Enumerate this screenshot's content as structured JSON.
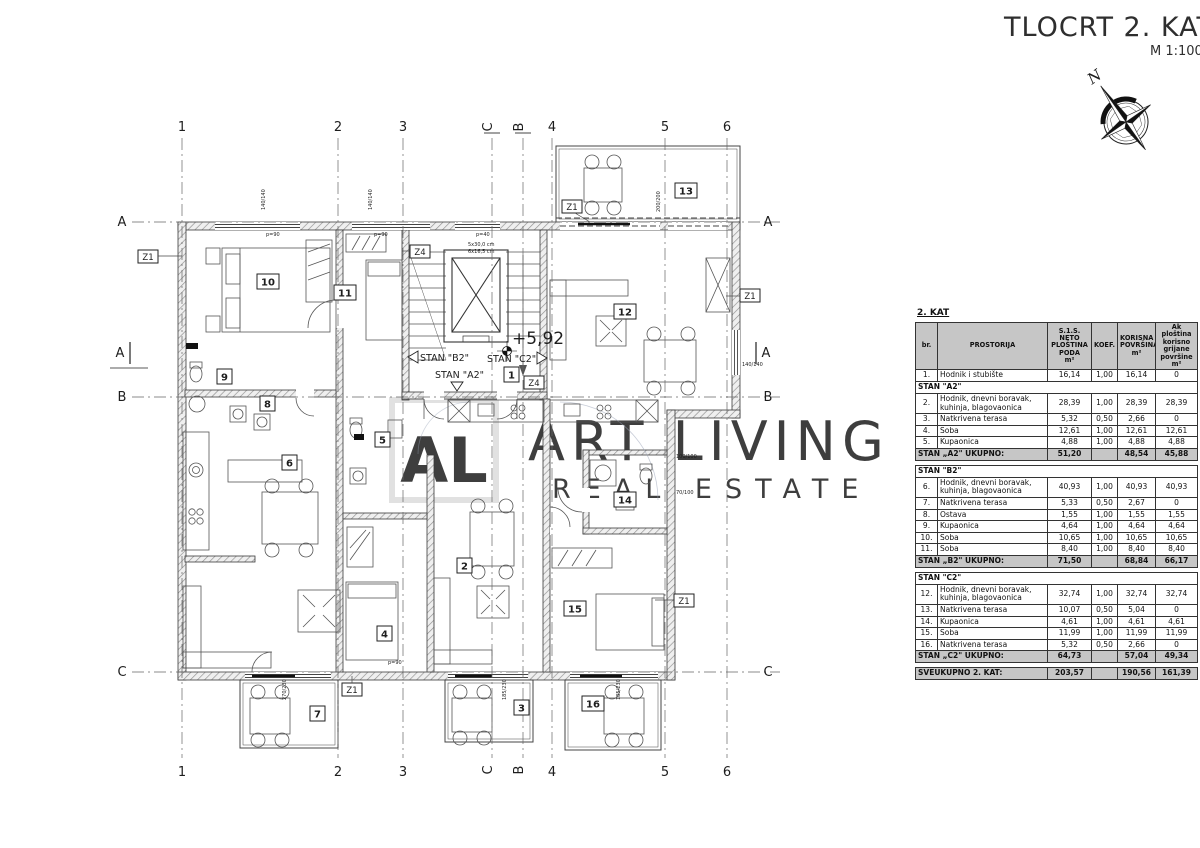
{
  "title": {
    "main": "TLOCRT 2. KATA",
    "scale": "M 1:100"
  },
  "compass": {
    "north": "N"
  },
  "watermark": {
    "logo": "AL",
    "line1": "ART LIVING",
    "line2": "REAL ESTATE"
  },
  "plan": {
    "grid_cols": [
      "1",
      "2",
      "3",
      "C",
      "B",
      "4",
      "5",
      "6"
    ],
    "grid_rows": [
      "A",
      "B",
      "C"
    ],
    "section_marker": "A",
    "rooms": [
      "1",
      "2",
      "3",
      "4",
      "5",
      "6",
      "7",
      "8",
      "9",
      "10",
      "11",
      "12",
      "13",
      "14",
      "15",
      "16"
    ],
    "zones": {
      "z1": "Z1",
      "z4": "Z4"
    },
    "apartments": {
      "a2": "STAN \"A2\"",
      "b2": "STAN \"B2\"",
      "c2": "STAN \"C2\""
    },
    "elevation": "+5,92",
    "stairs": {
      "note1": "5x30,0 cm",
      "note2": "6x16,5 cm"
    },
    "dims": {
      "p90": "p=90",
      "p40": "p=40",
      "d140": "140/140",
      "d270": "270/230",
      "d185": "185/230",
      "d100": "100/100",
      "d70": "70/100",
      "d200": "200/200"
    }
  },
  "table": {
    "caption": "2. KAT",
    "columns": [
      "br.",
      "PROSTORIJA",
      "S.1.S.\nNETO\nPLOŠTINA\nPODA\nm²",
      "KOEF.",
      "KORISNA\nPOVRŠINA\nm²",
      "Ak ploština\nkorisno\ngrijane\npovršine\nm²"
    ],
    "rows": [
      {
        "type": "data",
        "br": "1.",
        "name": "Hodnik i stubište",
        "neto": "16,14",
        "koef": "1,00",
        "korisna": "16,14",
        "ak": "0"
      },
      {
        "type": "section",
        "label": "STAN \"A2\""
      },
      {
        "type": "data",
        "br": "2.",
        "name": "Hodnik, dnevni boravak,\nkuhinja, blagovaonica",
        "neto": "28,39",
        "koef": "1,00",
        "korisna": "28,39",
        "ak": "28,39"
      },
      {
        "type": "data",
        "br": "3.",
        "name": "Natkrivena terasa",
        "neto": "5,32",
        "koef": "0,50",
        "korisna": "2,66",
        "ak": "0"
      },
      {
        "type": "data",
        "br": "4.",
        "name": "Soba",
        "neto": "12,61",
        "koef": "1,00",
        "korisna": "12,61",
        "ak": "12,61"
      },
      {
        "type": "data",
        "br": "5.",
        "name": "Kupaonica",
        "neto": "4,88",
        "koef": "1,00",
        "korisna": "4,88",
        "ak": "4,88"
      },
      {
        "type": "total",
        "label": "STAN „A2\" UKUPNO:",
        "neto": "51,20",
        "korisna": "48,54",
        "ak": "45,88"
      },
      {
        "type": "spacer"
      },
      {
        "type": "section",
        "label": "STAN \"B2\""
      },
      {
        "type": "data",
        "br": "6.",
        "name": "Hodnik, dnevni boravak,\nkuhinja, blagovaonica",
        "neto": "40,93",
        "koef": "1,00",
        "korisna": "40,93",
        "ak": "40,93"
      },
      {
        "type": "data",
        "br": "7.",
        "name": "Natkrivena terasa",
        "neto": "5,33",
        "koef": "0,50",
        "korisna": "2,67",
        "ak": "0"
      },
      {
        "type": "data",
        "br": "8.",
        "name": "Ostava",
        "neto": "1,55",
        "koef": "1,00",
        "korisna": "1,55",
        "ak": "1,55"
      },
      {
        "type": "data",
        "br": "9.",
        "name": "Kupaonica",
        "neto": "4,64",
        "koef": "1,00",
        "korisna": "4,64",
        "ak": "4,64"
      },
      {
        "type": "data",
        "br": "10.",
        "name": "Soba",
        "neto": "10,65",
        "koef": "1,00",
        "korisna": "10,65",
        "ak": "10,65"
      },
      {
        "type": "data",
        "br": "11.",
        "name": "Soba",
        "neto": "8,40",
        "koef": "1,00",
        "korisna": "8,40",
        "ak": "8,40"
      },
      {
        "type": "total",
        "label": "STAN „B2\" UKUPNO:",
        "neto": "71,50",
        "korisna": "68,84",
        "ak": "66,17"
      },
      {
        "type": "spacer"
      },
      {
        "type": "section",
        "label": "STAN \"C2\""
      },
      {
        "type": "data",
        "br": "12.",
        "name": "Hodnik, dnevni boravak,\nkuhinja, blagovaonica",
        "neto": "32,74",
        "koef": "1,00",
        "korisna": "32,74",
        "ak": "32,74"
      },
      {
        "type": "data",
        "br": "13.",
        "name": "Natkrivena terasa",
        "neto": "10,07",
        "koef": "0,50",
        "korisna": "5,04",
        "ak": "0"
      },
      {
        "type": "data",
        "br": "14.",
        "name": "Kupaonica",
        "neto": "4,61",
        "koef": "1,00",
        "korisna": "4,61",
        "ak": "4,61"
      },
      {
        "type": "data",
        "br": "15.",
        "name": "Soba",
        "neto": "11,99",
        "koef": "1,00",
        "korisna": "11,99",
        "ak": "11,99"
      },
      {
        "type": "data",
        "br": "16.",
        "name": "Natkrivena terasa",
        "neto": "5,32",
        "koef": "0,50",
        "korisna": "2,66",
        "ak": "0"
      },
      {
        "type": "total",
        "label": "STAN „C2\" UKUPNO:",
        "neto": "64,73",
        "korisna": "57,04",
        "ak": "49,34"
      },
      {
        "type": "spacer"
      },
      {
        "type": "grand",
        "label": "SVEUKUPNO 2. KAT:",
        "neto": "203,57",
        "korisna": "190,56",
        "ak": "161,39"
      }
    ]
  }
}
